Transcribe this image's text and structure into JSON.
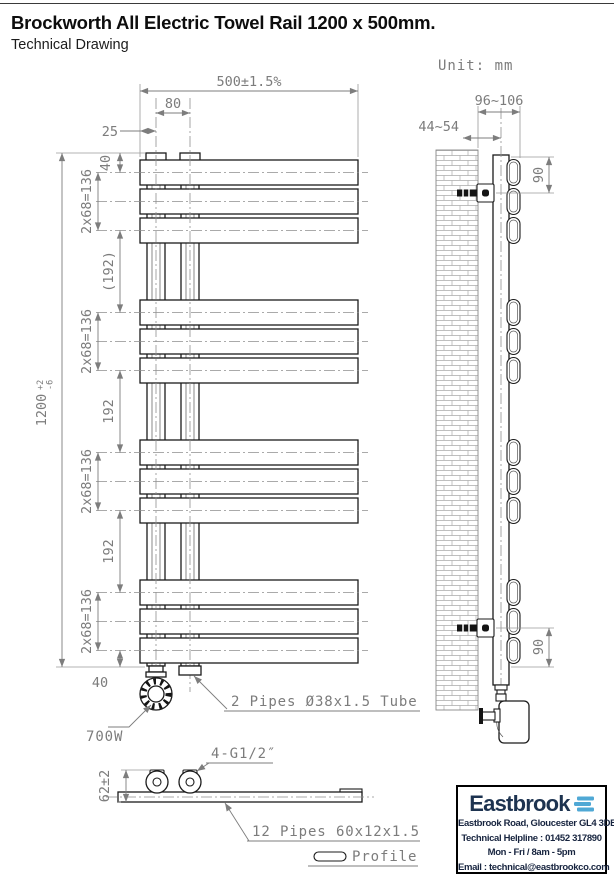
{
  "header": {
    "title": "Brockworth All Electric Towel Rail 1200 x 500mm.",
    "subtitle": "Technical Drawing",
    "unit_label": "Unit: mm"
  },
  "front_view": {
    "width_dim": "500±1.5%",
    "tube_spacing_dim": "80",
    "tube_offset_dim": "25",
    "top_offset_dim": "40",
    "bar_group_dim": "2x68=136",
    "gap_dim_ref": "(192)",
    "gap_dim": "192",
    "bottom_offset_dim": "40",
    "height_dim": "1200",
    "height_tol_plus": "+2",
    "height_tol_minus": "-6",
    "power_label": "700W",
    "pipes_label": "2 Pipes Ø38x1.5 Tube"
  },
  "side_view": {
    "depth_dim": "96~106",
    "wall_gap_dim": "44~54",
    "bracket_top_dim": "90",
    "bracket_bottom_dim": "90"
  },
  "section_view": {
    "connections_label": "4-G1/2″",
    "height_dim": "62±2",
    "pipes_label": "12 Pipes 60x12x1.5",
    "profile_label": "Profile"
  },
  "footer": {
    "brand": "Eastbrook",
    "address": "Eastbrook Road, Gloucester GL4 3DB",
    "helpline": "Technical Helpline : 01452 317890",
    "hours": "Mon - Fri / 8am - 5pm",
    "email": "Email : technical@eastbrookco.com"
  },
  "colors": {
    "brand_navy": "#1d3350",
    "brand_blue": "#4fa8d5",
    "dim_gray": "#7d7d7d",
    "line_black": "#1b1b1b"
  }
}
